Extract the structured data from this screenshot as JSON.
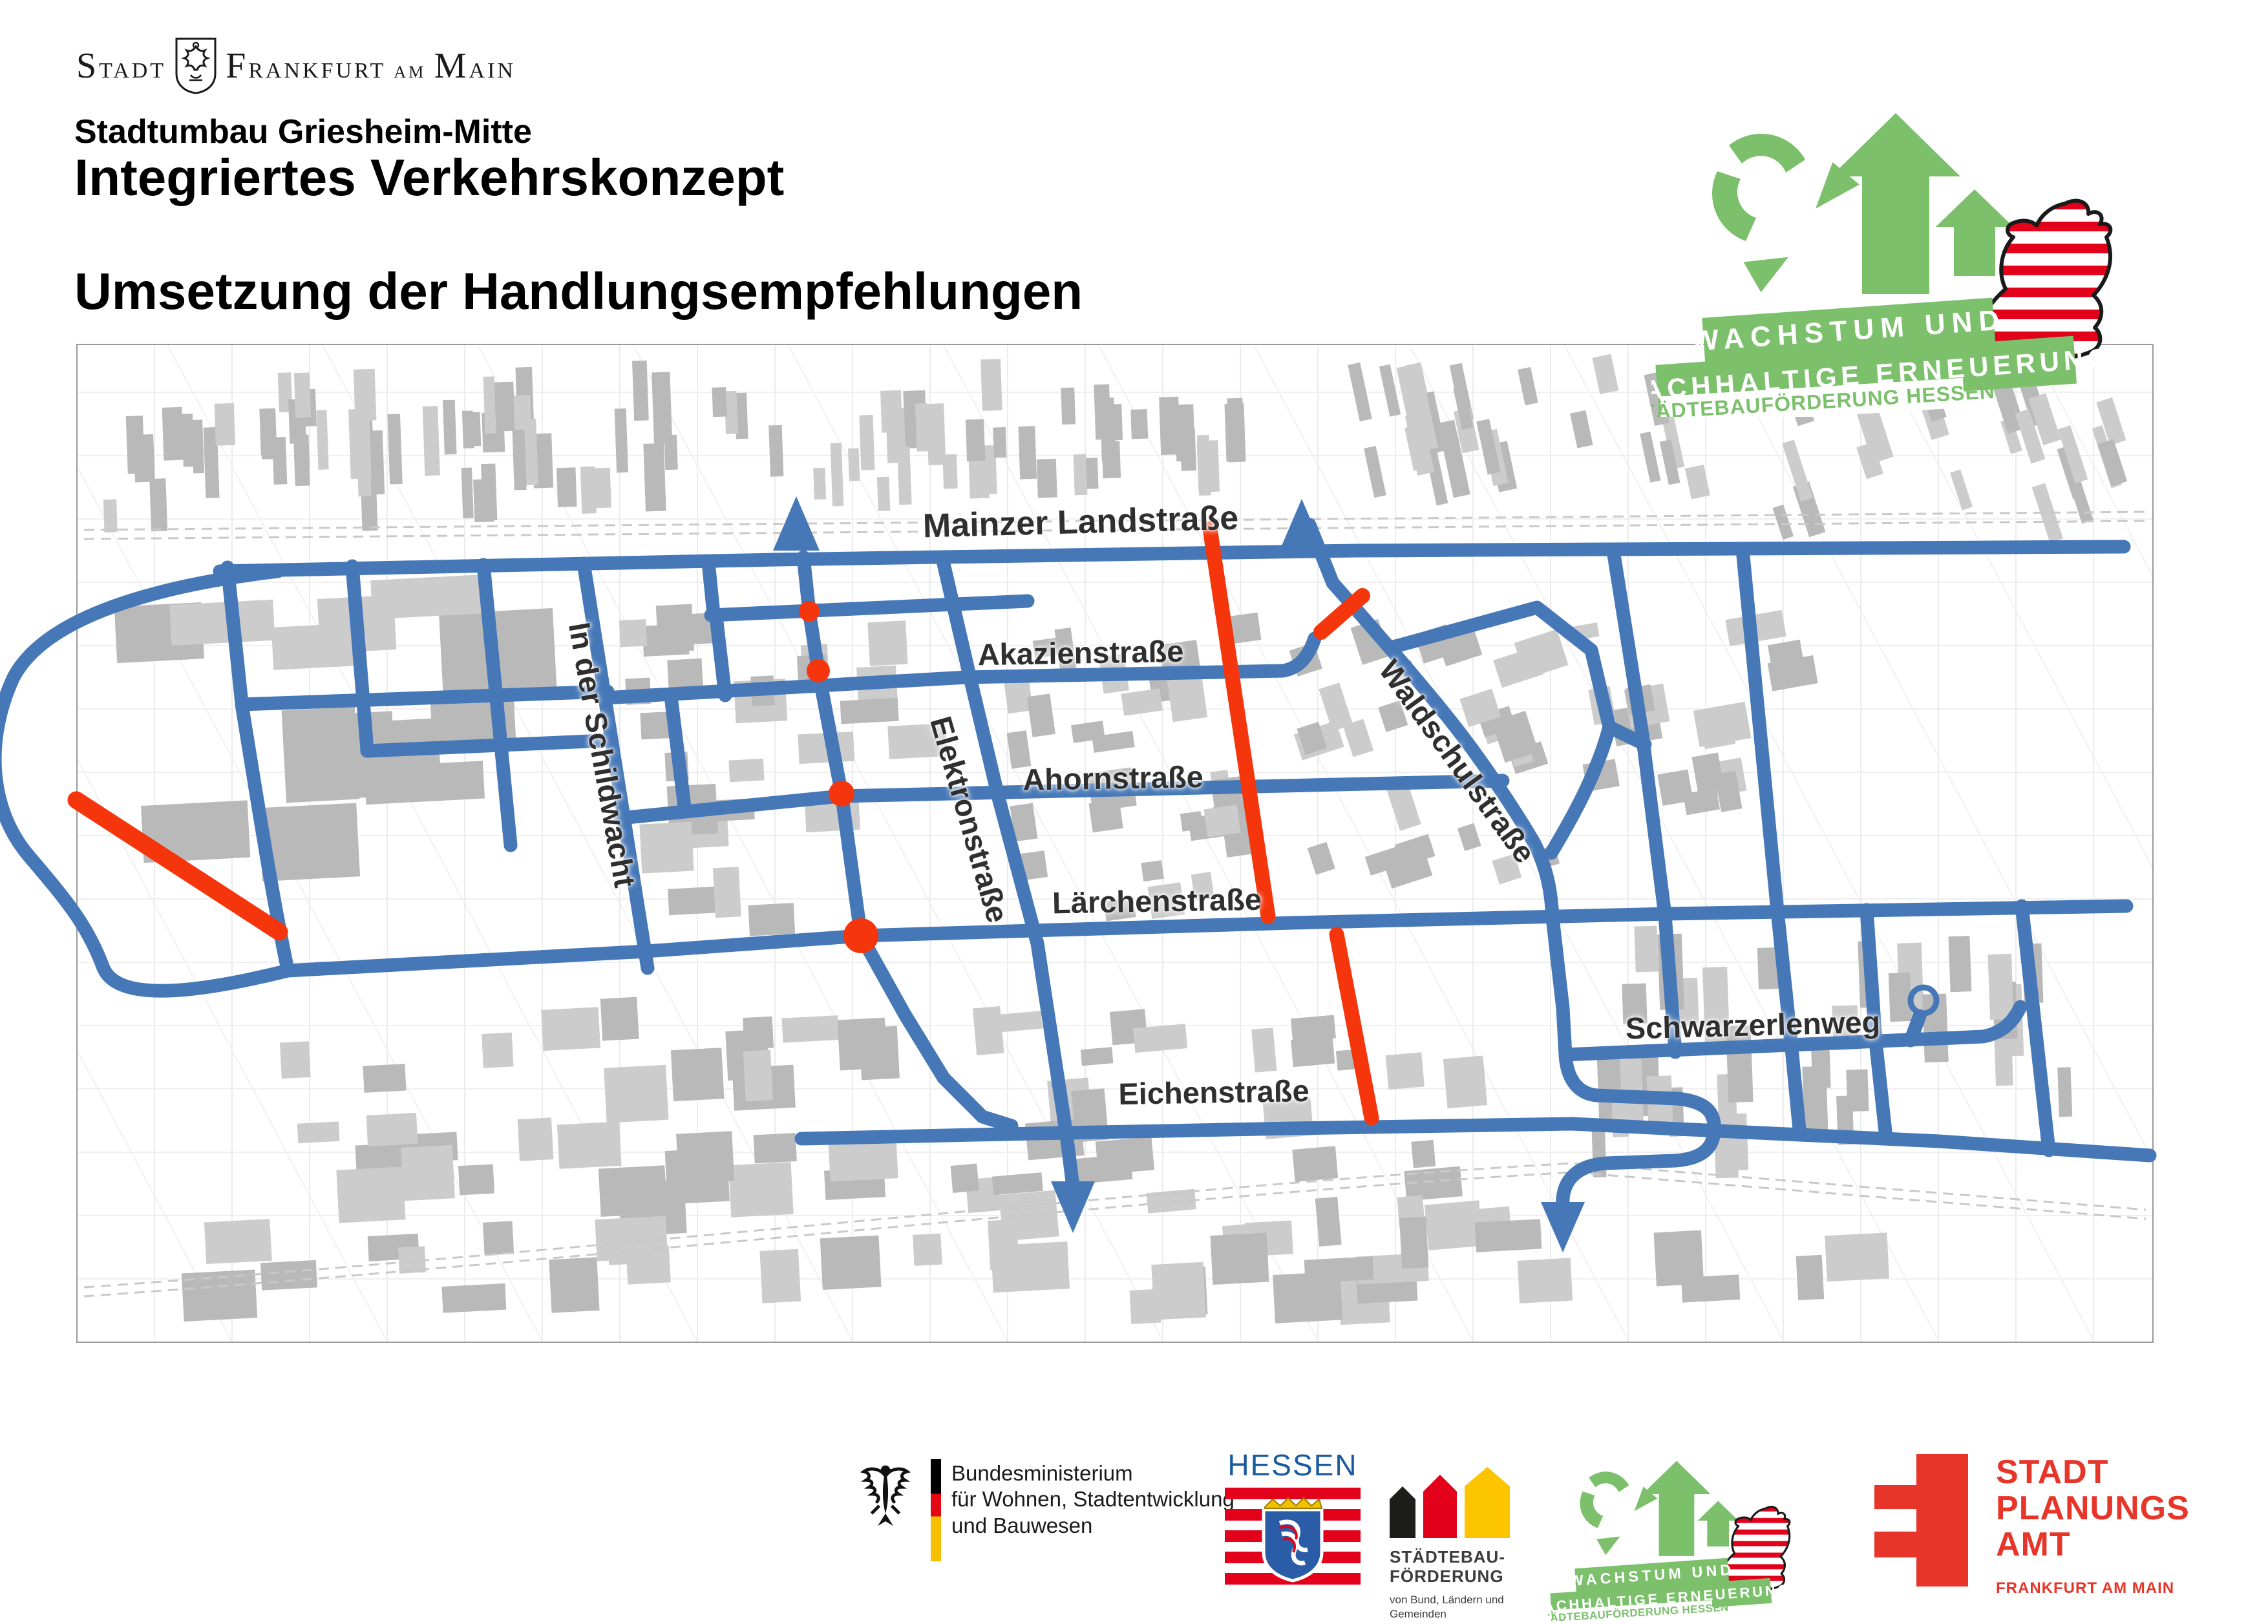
{
  "header": {
    "city_logo_stadt": "Stadt",
    "city_logo_city": "Frankfurt am Main",
    "subtitle": "Stadtumbau Griesheim-Mitte",
    "title": "Integriertes Verkehrskonzept",
    "heading": "Umsetzung der Handlungsempfehlungen"
  },
  "growth_logo": {
    "line1": "WACHSTUM UND",
    "line2": "NACHHALTIGE ERNEUERUNG",
    "line3": "STÄDTEBAUFÖRDERUNG HESSEN",
    "green": "#7cc06c"
  },
  "map": {
    "road_color": "#4678b8",
    "highlight_color": "#f5350c",
    "building_color": "#bcbcbc",
    "streets": [
      {
        "name": "Mainzer Landstraße"
      },
      {
        "name": "Akazienstraße"
      },
      {
        "name": "Ahornstraße"
      },
      {
        "name": "Lärchenstraße"
      },
      {
        "name": "Eichenstraße"
      },
      {
        "name": "Schwarzerlenweg"
      },
      {
        "name": "In der Schildwacht"
      },
      {
        "name": "Elektronstraße"
      },
      {
        "name": "Waldschulstraße"
      }
    ],
    "markers": {
      "red_segment_count": 4,
      "red_dot_count": 4,
      "up_arrow_count": 2,
      "down_arrow_count": 2
    }
  },
  "footer": {
    "bmwsb_line1": "Bundesministerium",
    "bmwsb_line2": "für Wohnen, Stadtentwicklung",
    "bmwsb_line3": "und Bauwesen",
    "hessen_name": "HESSEN",
    "staedtebau_line1": "STÄDTEBAU-",
    "staedtebau_line2": "FÖRDERUNG",
    "staedtebau_small1": "von Bund, Ländern und",
    "staedtebau_small2": "Gemeinden",
    "spa_line1": "STADT",
    "spa_line2": "PLANUNGS",
    "spa_line3": "AMT",
    "spa_sub": "FRANKFURT AM MAIN"
  }
}
